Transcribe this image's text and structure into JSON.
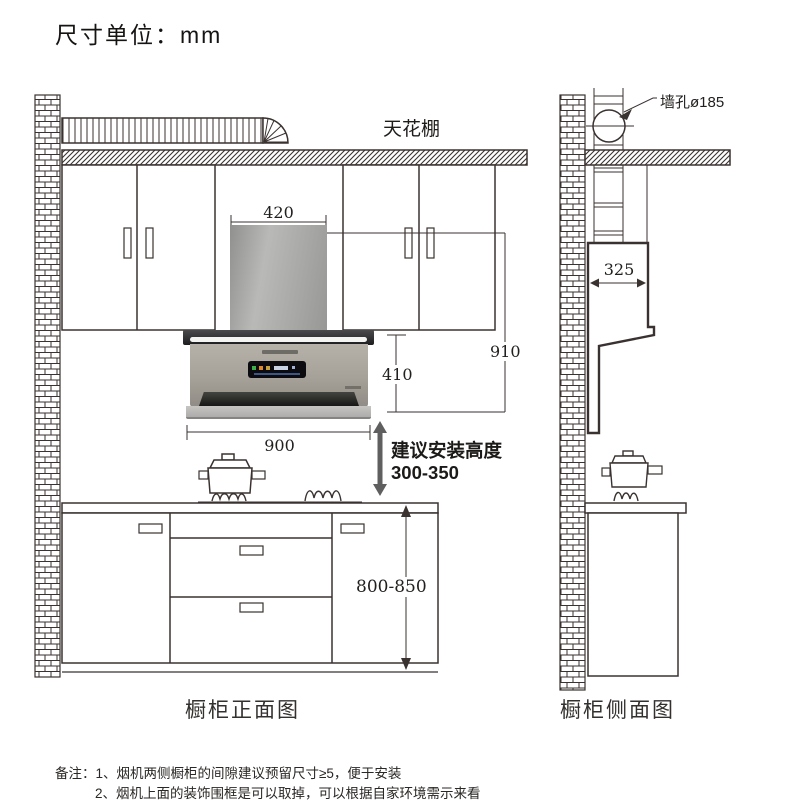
{
  "title": "尺寸单位：mm",
  "front_view": {
    "caption": "橱柜正面图",
    "ceiling_label": "天花棚",
    "dim_chimney_width": "420",
    "dim_total_height": "910",
    "dim_hood_height": "410",
    "dim_hood_width": "900",
    "dim_counter_height": "800-850",
    "install_line1": "建议安装高度",
    "install_line2": "300-350"
  },
  "side_view": {
    "caption": "橱柜侧面图",
    "wall_hole_label": "墙孔ø185",
    "dim_depth": "325"
  },
  "notes": {
    "line1": "备注：1、烟机两侧橱柜的间隙建议预留尺寸≥5，便于安装",
    "line2": "2、烟机上面的装饰围框是可以取掉，可以根据自家环境需示来看"
  },
  "colors": {
    "line": "#3a3230",
    "hood_body": "#a5a199",
    "hood_chimney": "#a7a7a5",
    "install_arrow": "#5f5f5f"
  }
}
